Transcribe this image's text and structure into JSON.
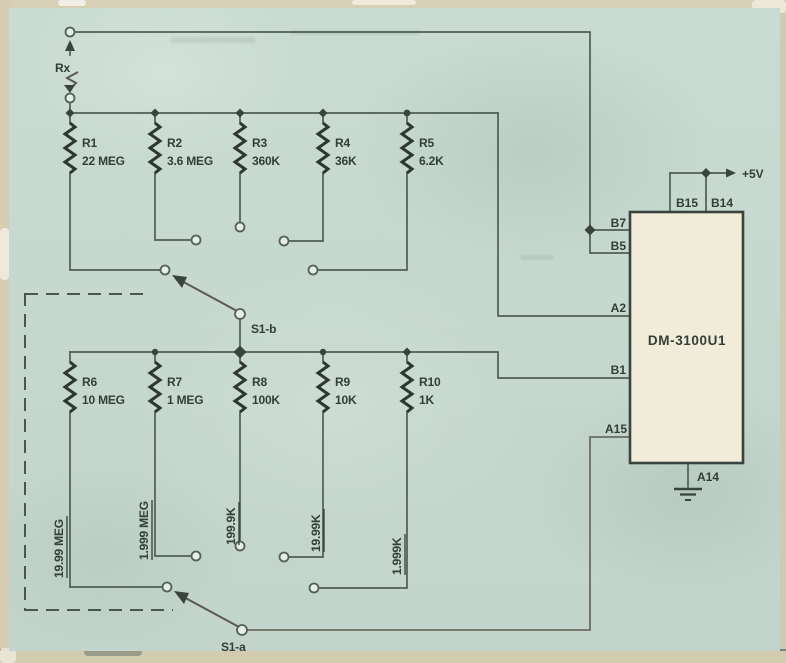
{
  "diagram_type": "schematic",
  "colors": {
    "paper": "#c7d9d0",
    "frame_edge": "#d5cdb2",
    "wire": "#4f5d55",
    "text": "#333e37",
    "chip_fill": "#f1ebd9",
    "chip_border": "#39443c"
  },
  "terminals": {
    "rx_label": "Rx"
  },
  "upper_resistors": [
    {
      "name": "R1",
      "value": "22 MEG"
    },
    {
      "name": "R2",
      "value": "3.6 MEG"
    },
    {
      "name": "R3",
      "value": "360K"
    },
    {
      "name": "R4",
      "value": "36K"
    },
    {
      "name": "R5",
      "value": "6.2K"
    }
  ],
  "lower_resistors": [
    {
      "name": "R6",
      "value": "10 MEG"
    },
    {
      "name": "R7",
      "value": "1 MEG"
    },
    {
      "name": "R8",
      "value": "100K"
    },
    {
      "name": "R9",
      "value": "10K"
    },
    {
      "name": "R10",
      "value": "1K"
    }
  ],
  "range_labels": [
    "19.99 MEG",
    "1.999 MEG",
    "199.9K",
    "19.99K",
    "1.999K"
  ],
  "switches": {
    "s1b_label": "S1-b",
    "s1a_label": "S1-a"
  },
  "ic": {
    "label": "DM-3100U1",
    "supply_label": "+5V",
    "pins": {
      "b15": "B15",
      "b14": "B14",
      "b7": "B7",
      "b5": "B5",
      "a2": "A2",
      "b1": "B1",
      "a15": "A15",
      "a14": "A14"
    }
  }
}
